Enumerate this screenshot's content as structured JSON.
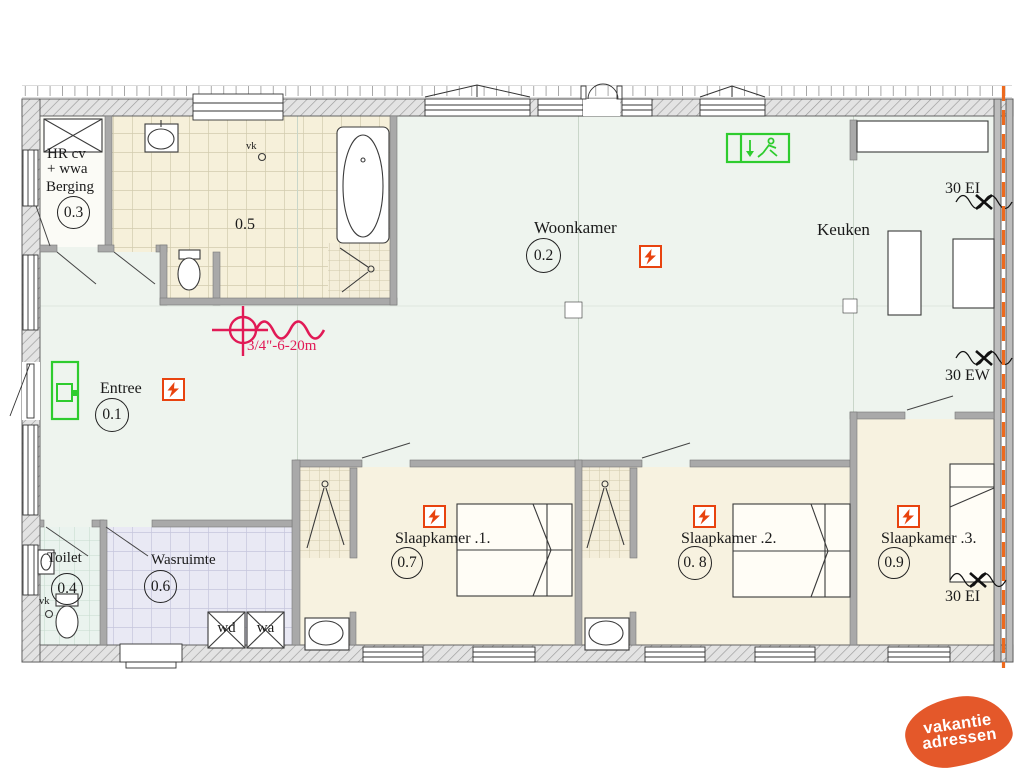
{
  "plan": {
    "rooms": {
      "entree": {
        "name": "Entree",
        "number": "0.1"
      },
      "woonkamer": {
        "name": "Woonkamer",
        "number": "0.2"
      },
      "berging": {
        "name": "Berging",
        "number": "0.3"
      },
      "toilet": {
        "name": "Toilet",
        "number": "0.4"
      },
      "badkamer": {
        "number": "0.5"
      },
      "wasruimte": {
        "name": "Wasruimte",
        "number": "0.6"
      },
      "slaapkamer1": {
        "name": "Slaapkamer .1.",
        "number": "0.7"
      },
      "slaapkamer2": {
        "name": "Slaapkamer .2.",
        "number": "0. 8"
      },
      "slaapkamer3": {
        "name": "Slaapkamer .3.",
        "number": "0.9"
      },
      "keuken": {
        "name": "Keuken"
      }
    },
    "annotations": {
      "boiler_line1": "HR cv",
      "boiler_line2": "+ wwa",
      "vent_badkamer": "vk",
      "vent_toilet": "vk",
      "washer": "wd",
      "dryer": "wa",
      "fire_top_right": "30 EI",
      "fire_mid_right": "30 EW",
      "fire_bottom_right": "30 EI",
      "gas_pipe": "3/4\"-6-20m"
    },
    "colors": {
      "living_floor": "#eef4ee",
      "bedroom_floor": "#f7f2e0",
      "laundry_floor": "#e9e9f4",
      "toilet_floor": "#eaf3ee",
      "smoke_detector": "#e8430f",
      "escape_green": "#2ecc2e",
      "gas_red": "#e11a56",
      "fire_line_orange": "#ed6a1e"
    }
  },
  "logo": {
    "line1": "vakantie",
    "line2": "adressen",
    "color": "#e4582a"
  }
}
